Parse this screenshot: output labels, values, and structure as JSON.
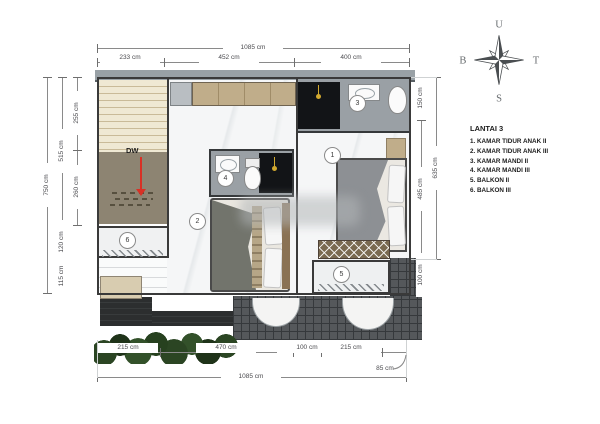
{
  "legend": {
    "title": "LANTAI 3",
    "items": [
      "1. KAMAR TIDUR ANAK II",
      "2. KAMAR TIDUR ANAK III",
      "3. KAMAR MANDI II",
      "4. KAMAR MANDI III",
      "5. BALKON II",
      "6. BALKON III"
    ]
  },
  "compass": {
    "north": "U",
    "west": "B",
    "east": "T",
    "south": "S"
  },
  "stairs": {
    "label": "DW"
  },
  "markers": [
    "1",
    "2",
    "3",
    "4",
    "5",
    "6"
  ],
  "dims": {
    "top": {
      "overall": "1085 cm",
      "seg1": "233 cm",
      "seg2": "452 cm",
      "seg3": "400 cm"
    },
    "left": {
      "overall": "750 cm",
      "span": "515 cm",
      "seg1": "255 cm",
      "seg2": "260 cm",
      "seg3": "120 cm",
      "seg4": "115 cm"
    },
    "right": {
      "overall": "635 cm",
      "seg1": "150 cm",
      "seg2": "485 cm",
      "seg3": "100 cm"
    },
    "bottom": {
      "seg1": "215 cm",
      "seg2": "470 cm",
      "seg3": "100 cm",
      "seg4": "215 cm",
      "overhang": "85 cm",
      "overall": "1085 cm"
    }
  },
  "colors": {
    "arrow-red": "#d93025",
    "fixture-gold": "#d2a92f",
    "plant-green": "#2b4523",
    "tile-roof": "#55585b",
    "wood-tan": "#c0ad8a",
    "wall": "#3a3a3a",
    "dim-line": "#8a8a8a"
  }
}
